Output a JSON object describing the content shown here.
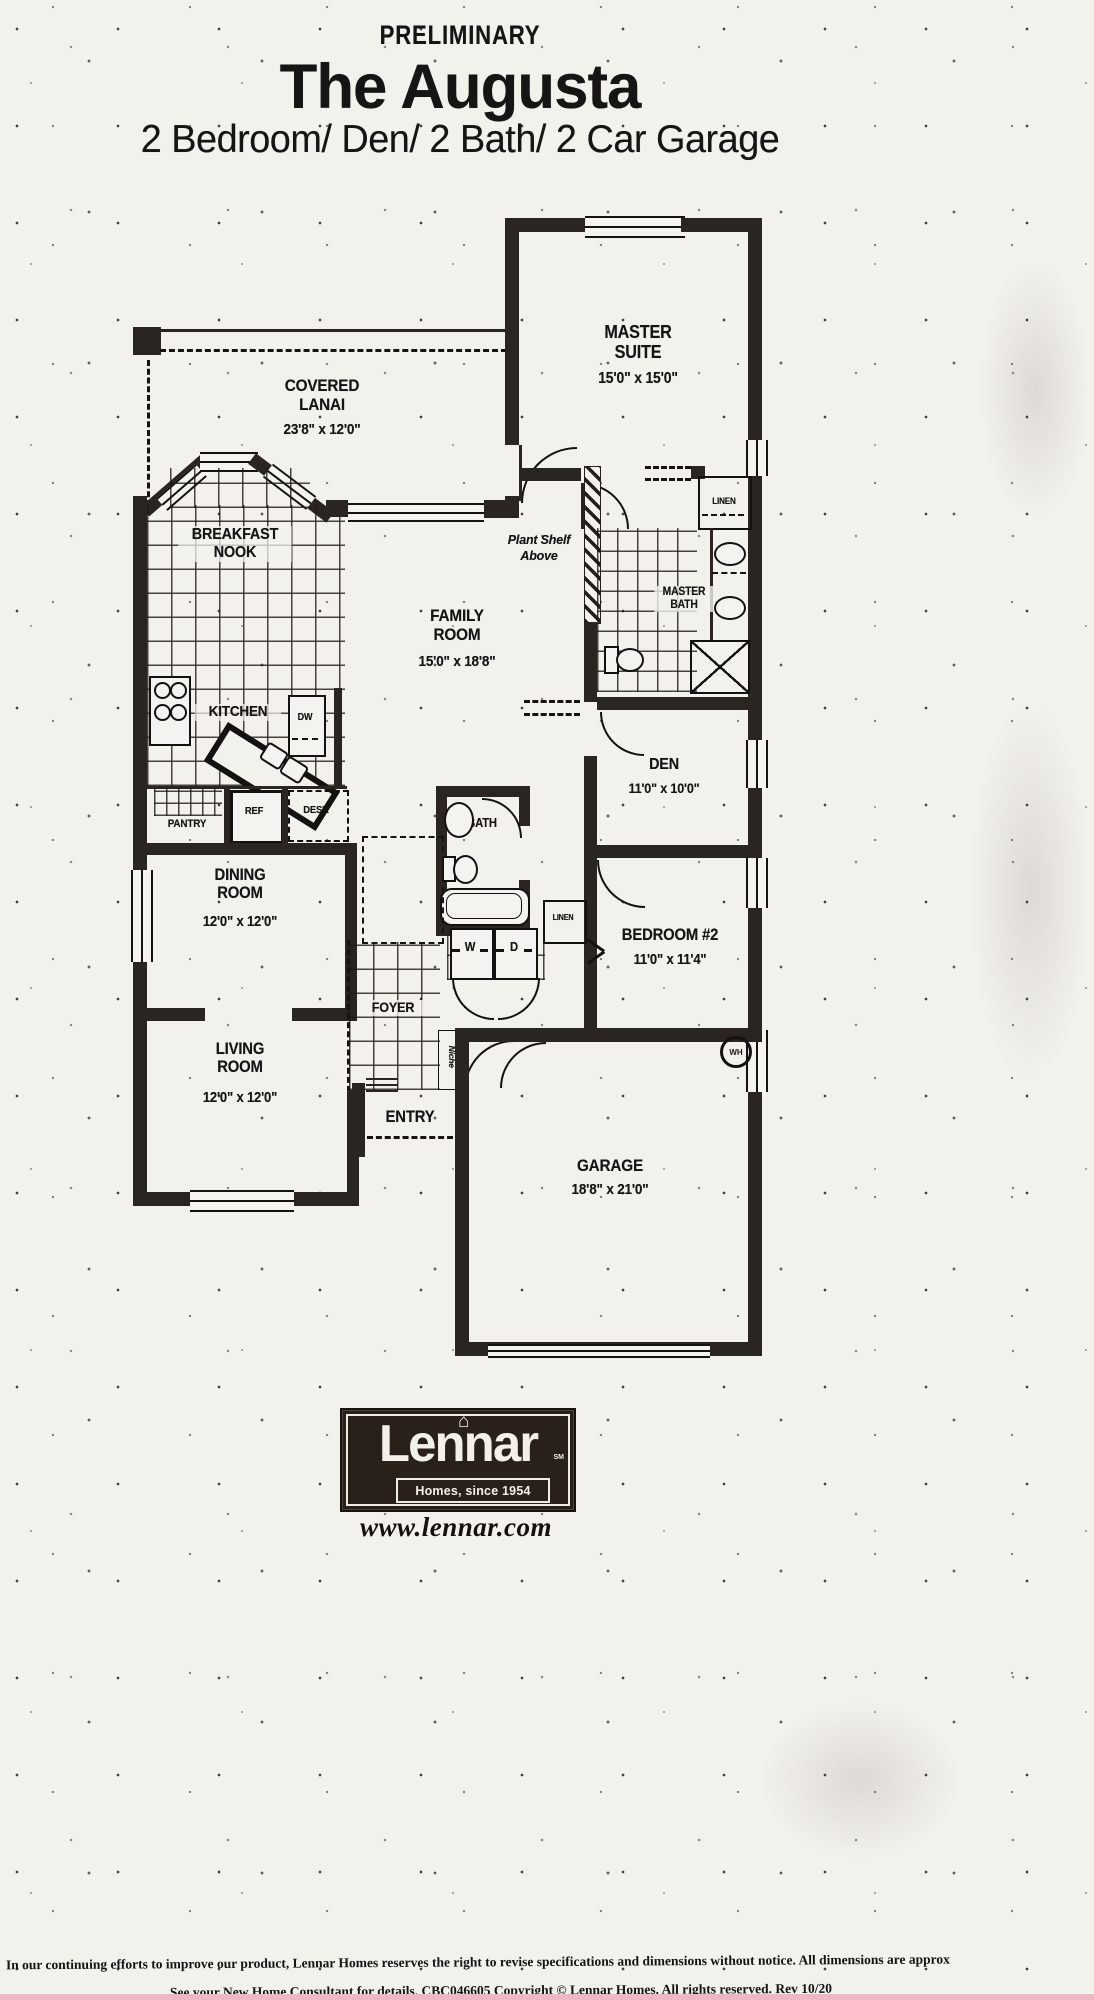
{
  "page": {
    "doc_label": "PRELIMINARY",
    "title": "The Augusta",
    "subtitle": "2 Bedroom/ Den/ 2 Bath/ 2 Car Garage"
  },
  "rooms": {
    "master_suite": {
      "name": "MASTER SUITE",
      "dims": "15'0\" x 15'0\""
    },
    "covered_lanai": {
      "name": "COVERED LANAI",
      "dims": "23'8\" x 12'0\""
    },
    "breakfast_nook": {
      "name": "BREAKFAST NOOK"
    },
    "family_room": {
      "name": "FAMILY ROOM",
      "dims": "15'0\" x 18'8\""
    },
    "kitchen": {
      "name": "KITCHEN"
    },
    "master_bath": {
      "name": "MASTER BATH"
    },
    "den": {
      "name": "DEN",
      "dims": "11'0\" x 10'0\""
    },
    "dining_room": {
      "name": "DINING ROOM",
      "dims": "12'0\" x 12'0\""
    },
    "bedroom_2": {
      "name": "BEDROOM #2",
      "dims": "11'0\" x 11'4\""
    },
    "living_room": {
      "name": "LIVING ROOM",
      "dims": "12'0\" x 12'0\""
    },
    "foyer": {
      "name": "FOYER"
    },
    "entry": {
      "name": "ENTRY"
    },
    "bath_2": {
      "name": "BATH"
    },
    "garage": {
      "name": "GARAGE",
      "dims": "18'8\" x 21'0\""
    },
    "pantry": {
      "name": "PANTRY"
    }
  },
  "fixtures": {
    "dishwasher": "DW",
    "refrigerator": "REF",
    "desk": "DESK",
    "linen_master": "LINEN",
    "linen_hall": "LINEN",
    "washer": "W",
    "dryer": "D",
    "water_heater": "WH",
    "niche": "Niche",
    "plant_shelf": "Plant Shelf Above"
  },
  "icons": {
    "house_logo": "⌂"
  },
  "footer": {
    "brand": "Lennar",
    "brand_mark": "SM",
    "tagline": "Homes, since 1954",
    "website": "www.lennar.com",
    "disclaimer_line1": "In our continuing efforts to improve our product, Lennar Homes reserves the right to revise specifications and dimensions without notice. All dimensions are approx",
    "disclaimer_line2": "See your New Home Consultant for details. CBC046605 Copyright ©  Lennar Homes. All rights reserved. Rev 10/20"
  },
  "colors": {
    "paper": "#f3f1ec",
    "ink": "#1b1816",
    "wall": "#2b2521",
    "scan_line": "#eeb7c3"
  }
}
